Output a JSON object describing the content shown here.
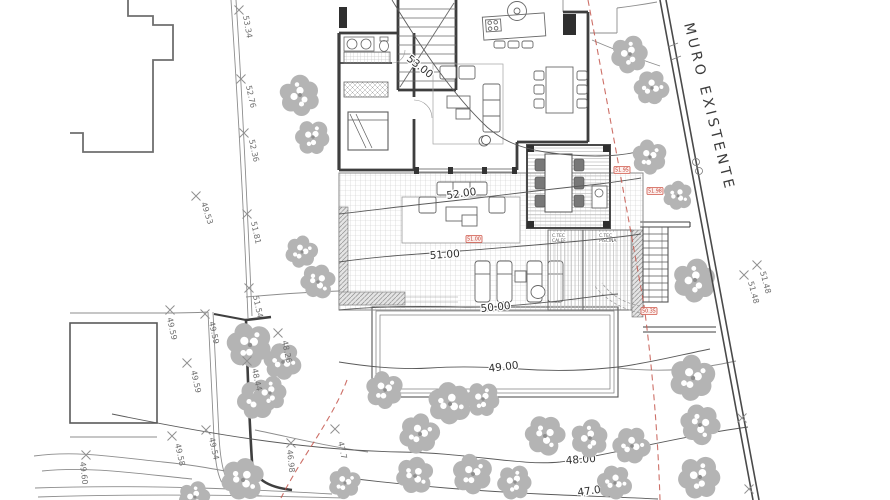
{
  "drawing": {
    "wall_label": "MURO EXISTENTE",
    "contour_labels": [
      "53.00",
      "52.00",
      "51.00",
      "50.00",
      "49.00",
      "48.00",
      "47.00"
    ],
    "spot_elevations": [
      "53.34",
      "52.76",
      "52.36",
      "49.53",
      "51.81",
      "51.54",
      "49.59",
      "49.59",
      "49.59",
      "49.58",
      "49.54",
      "49.60",
      "48.26",
      "48.44",
      "46.98",
      "47.7",
      "51.48",
      "51.48"
    ],
    "tech_rooms": [
      {
        "line1": "C.TEC",
        "line2": "CALEF"
      },
      {
        "line1": "C.TEC",
        "line2": "PISCINA"
      }
    ],
    "red_tags": [
      "51.95",
      "51.98",
      "51.00",
      "50.35"
    ],
    "colors": {
      "linework": "#4a4a4a",
      "trees": "#b4b4b4",
      "boundary_red": "#c4574d",
      "tag_red": "#c0392b"
    }
  }
}
